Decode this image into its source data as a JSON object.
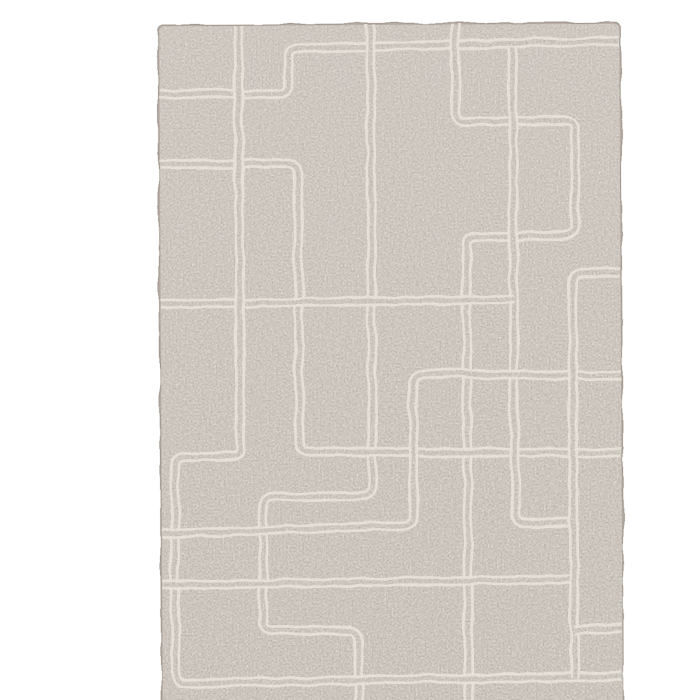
{
  "scene": {
    "description": "Product photograph of a hand-tufted wool rug on a plain white background. The rug has a grey-taupe mottled field decorated with an abstract maze-like pattern of paired thin cream lines that form rectilinear hooks and rectangles, many of which run off the rug edges.",
    "background_color": "#ffffff"
  },
  "rug": {
    "x": 120,
    "y": 8,
    "width": 462,
    "height": 683,
    "corner_radius": 5,
    "rotation_deg": -0.3,
    "field_color_top": "#b8afa7",
    "field_color_bottom": "#b1a89f",
    "field_color_flat": "#b4aba2",
    "edge_color": "#a29990",
    "line_color": "#ede7db",
    "line_pair_outer_width": 10,
    "line_pair_gap_width": 4.6,
    "corner_round_radius": 10,
    "fleck_light": "#ccc4ba",
    "fleck_dark": "#8d857c",
    "pattern_paths": [
      {
        "name": "top-left-step-hook",
        "points": [
          [
            116,
            77
          ],
          [
            250,
            77
          ],
          [
            250,
            32
          ],
          [
            584,
            26
          ]
        ]
      },
      {
        "name": "upper-right-flag-column",
        "points": [
          [
            417,
            4
          ],
          [
            417,
            106
          ],
          [
            536,
            106
          ],
          [
            536,
            221
          ],
          [
            427,
            221
          ],
          [
            427,
            694
          ]
        ]
      },
      {
        "name": "center-long-zigzag",
        "points": [
          [
            332,
            4
          ],
          [
            332,
            480
          ],
          [
            222,
            480
          ],
          [
            222,
            614
          ],
          [
            317,
            614
          ],
          [
            317,
            693
          ]
        ]
      },
      {
        "name": "left-elbow-to-right",
        "points": [
          [
            116,
            147
          ],
          [
            259,
            147
          ],
          [
            259,
            435
          ],
          [
            584,
            438
          ]
        ]
      },
      {
        "name": "mid-vertical-with-foot",
        "points": [
          [
            474,
            32
          ],
          [
            474,
            508
          ],
          [
            534,
            508
          ]
        ]
      },
      {
        "name": "middle-horizontal",
        "points": [
          [
            116,
            287
          ],
          [
            474,
            284
          ]
        ]
      },
      {
        "name": "left-column-big-hook",
        "points": [
          [
            200,
            4
          ],
          [
            200,
            440
          ],
          [
            134,
            440
          ],
          [
            134,
            666
          ],
          [
            584,
            661
          ]
        ]
      },
      {
        "name": "lower-left-u-to-right",
        "points": [
          [
            116,
            517
          ],
          [
            373,
            509
          ],
          [
            373,
            358
          ],
          [
            584,
            361
          ]
        ]
      },
      {
        "name": "lower-long-horizontal",
        "points": [
          [
            116,
            568
          ],
          [
            534,
            564
          ]
        ]
      },
      {
        "name": "right-bracket-column",
        "points": [
          [
            584,
            257
          ],
          [
            533,
            258
          ],
          [
            533,
            663
          ]
        ]
      },
      {
        "name": "bottom-right-stub",
        "points": [
          [
            533,
            615
          ],
          [
            584,
            612
          ]
        ]
      }
    ]
  }
}
